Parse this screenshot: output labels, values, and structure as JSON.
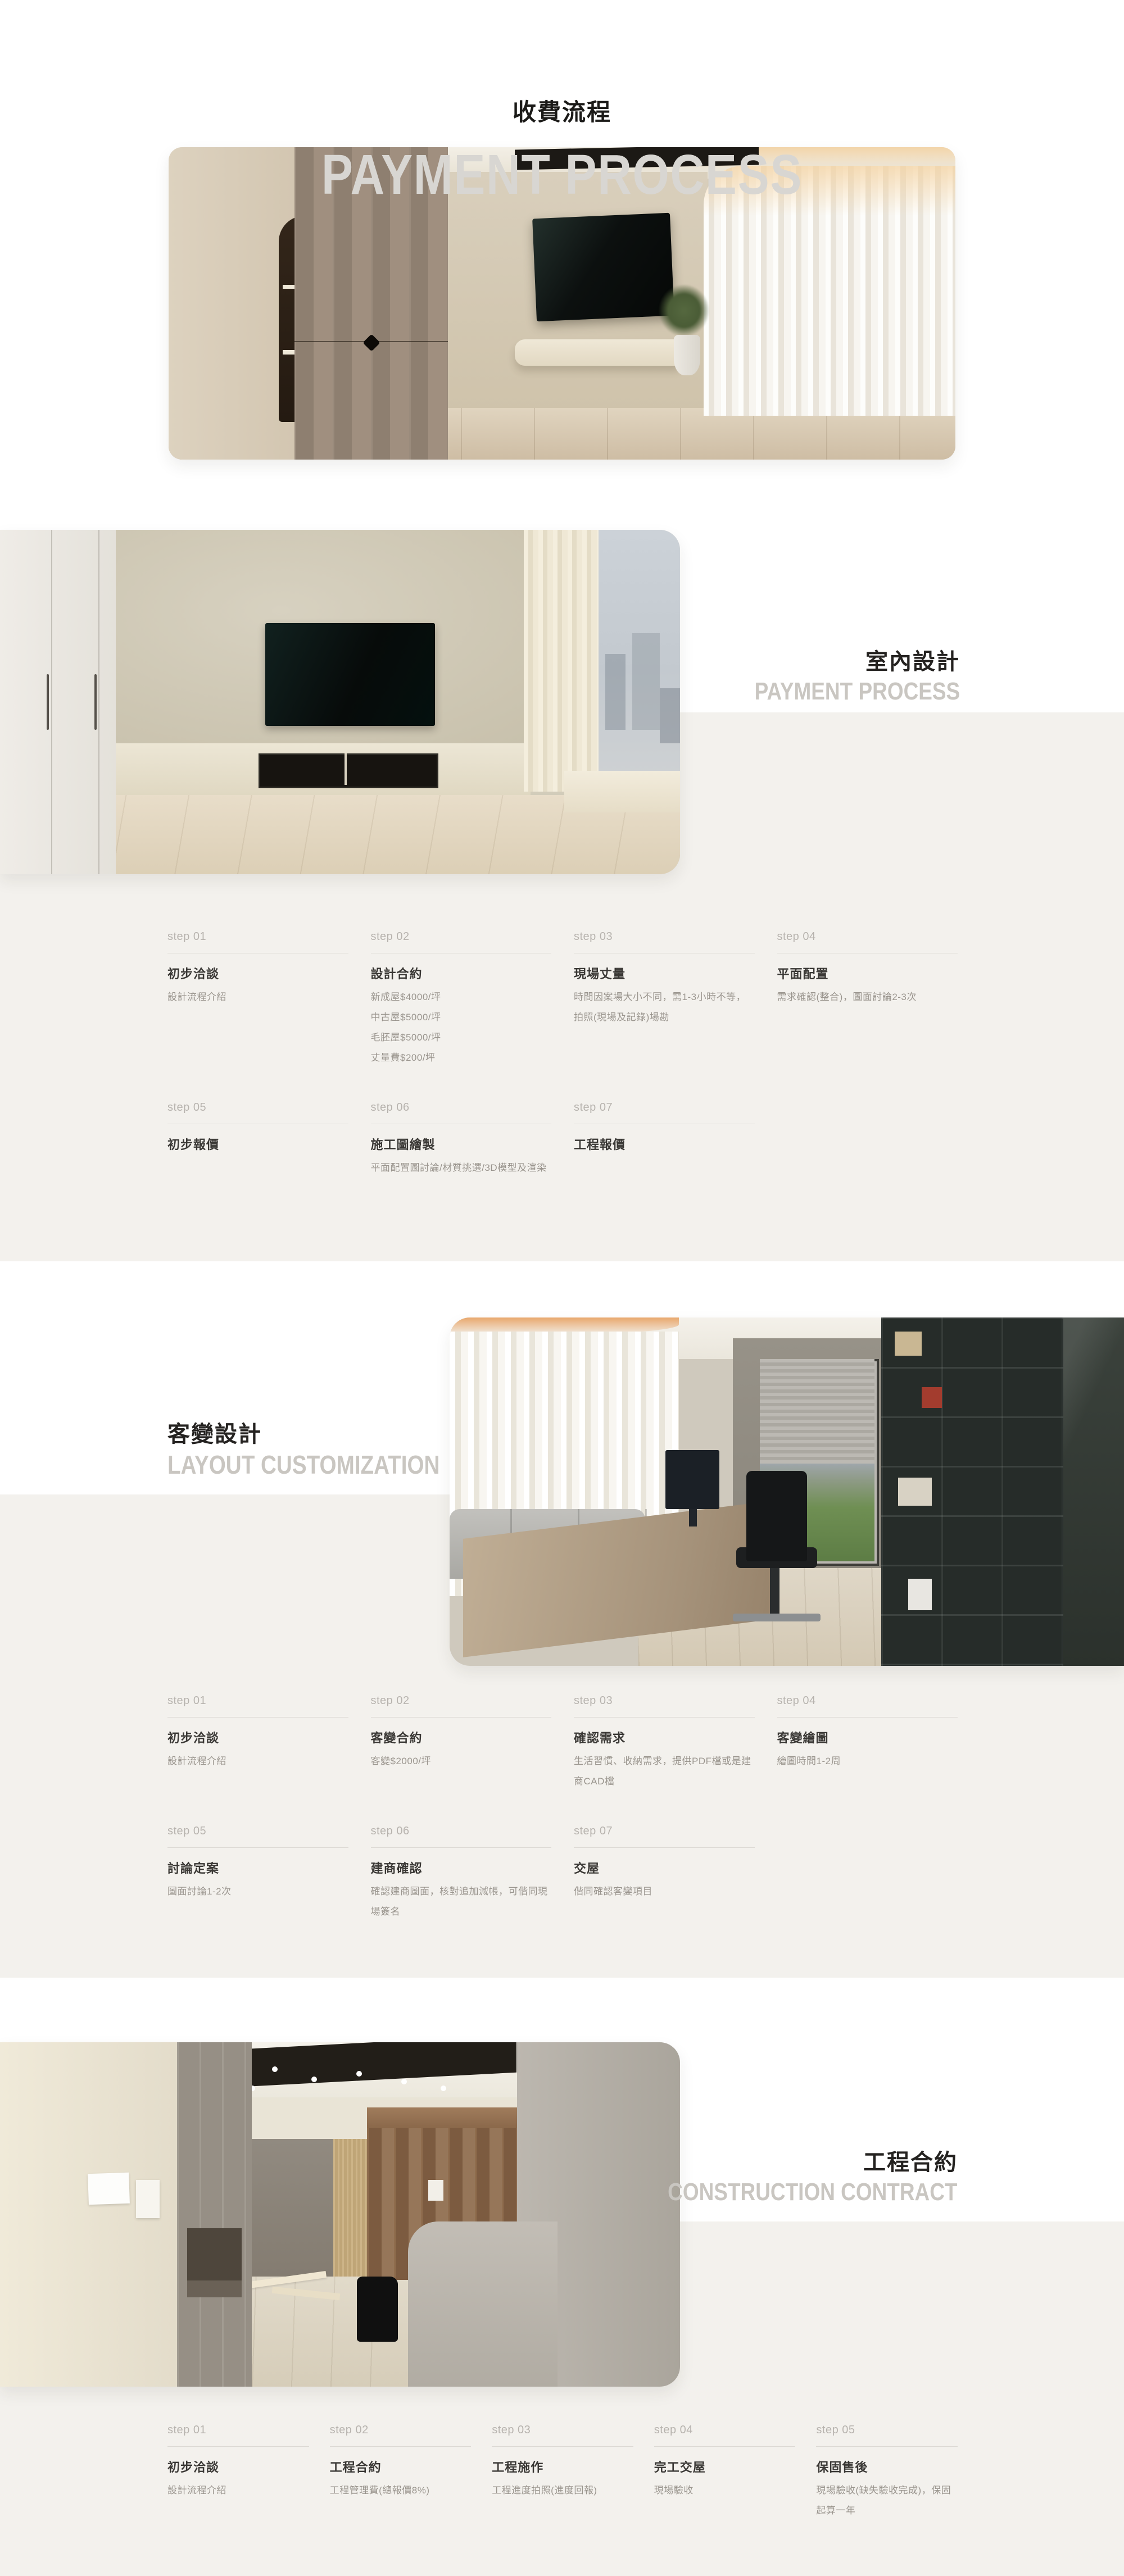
{
  "header": {
    "title_zh": "收費流程",
    "title_en": "PAYMENT PROCESS"
  },
  "sections": [
    {
      "title_zh": "室內設計",
      "title_en": "PAYMENT PROCESS",
      "title_side": "right",
      "steps": [
        {
          "label": "step 01",
          "title": "初步洽談",
          "desc": [
            "設計流程介紹"
          ]
        },
        {
          "label": "step 02",
          "title": "設計合約",
          "desc": [
            "新成屋$4000/坪",
            "中古屋$5000/坪",
            "毛胚屋$5000/坪",
            "丈量費$200/坪"
          ]
        },
        {
          "label": "step 03",
          "title": "現場丈量",
          "desc": [
            "時間因案場大小不同，需1-3小時不等，拍照(現場及記錄)場勘"
          ]
        },
        {
          "label": "step 04",
          "title": "平面配置",
          "desc": [
            "需求確認(整合)，圖面討論2-3次"
          ]
        },
        {
          "label": "step 05",
          "title": "初步報價",
          "desc": []
        },
        {
          "label": "step 06",
          "title": "施工圖繪製",
          "desc": [
            "平面配置圖討論/材質挑選/3D模型及渲染"
          ]
        },
        {
          "label": "step 07",
          "title": "工程報價",
          "desc": []
        }
      ]
    },
    {
      "title_zh": "客變設計",
      "title_en": "LAYOUT CUSTOMIZATION",
      "title_side": "left",
      "steps": [
        {
          "label": "step 01",
          "title": "初步洽談",
          "desc": [
            "設計流程介紹"
          ]
        },
        {
          "label": "step 02",
          "title": "客變合約",
          "desc": [
            "客變$2000/坪"
          ]
        },
        {
          "label": "step 03",
          "title": "確認需求",
          "desc": [
            "生活習慣、收納需求，提供PDF檔或是建商CAD檔"
          ]
        },
        {
          "label": "step 04",
          "title": "客變繪圖",
          "desc": [
            "繪圖時間1-2周"
          ]
        },
        {
          "label": "step 05",
          "title": "討論定案",
          "desc": [
            "圖面討論1-2次"
          ]
        },
        {
          "label": "step 06",
          "title": "建商確認",
          "desc": [
            "確認建商圖面，核對追加減帳，可偕同現場簽名"
          ]
        },
        {
          "label": "step 07",
          "title": "交屋",
          "desc": [
            "偕同確認客變項目"
          ]
        }
      ]
    },
    {
      "title_zh": "工程合約",
      "title_en": "CONSTRUCTION CONTRACT",
      "title_side": "right",
      "steps": [
        {
          "label": "step 01",
          "title": "初步洽談",
          "desc": [
            "設計流程介紹"
          ]
        },
        {
          "label": "step 02",
          "title": "工程合約",
          "desc": [
            "工程管理費(總報價8%)"
          ]
        },
        {
          "label": "step 03",
          "title": "工程施作",
          "desc": [
            "工程進度拍照(進度回報)"
          ]
        },
        {
          "label": "step 04",
          "title": "完工交屋",
          "desc": [
            "現場驗收"
          ]
        },
        {
          "label": "step 05",
          "title": "保固售後",
          "desc": [
            "現場驗收(缺失驗收完成)，保固起算一年"
          ]
        }
      ]
    }
  ],
  "photos": [
    {
      "name": "hero-living-room",
      "description": "living room with wood cabinets, wall TV and sheer curtains"
    },
    {
      "name": "interior-design-room",
      "description": "bedroom TV wall with white wardrobe and city window"
    },
    {
      "name": "layout-customization-office",
      "description": "home office with desk, chair and dark bookshelf"
    },
    {
      "name": "construction-site",
      "description": "construction site interior with wood wardrobe and gray partition"
    }
  ],
  "colors": {
    "background": "#ffffff",
    "band": "#f3f1ed",
    "heading_dark": "#1b1a18",
    "heading_gray": "#d8d6d2",
    "section_subtitle_gray": "#c9c6c1",
    "step_label": "#b7b3ae",
    "divider": "#dcd9d4",
    "step_title": "#3a3835",
    "step_desc": "#9a958e"
  }
}
